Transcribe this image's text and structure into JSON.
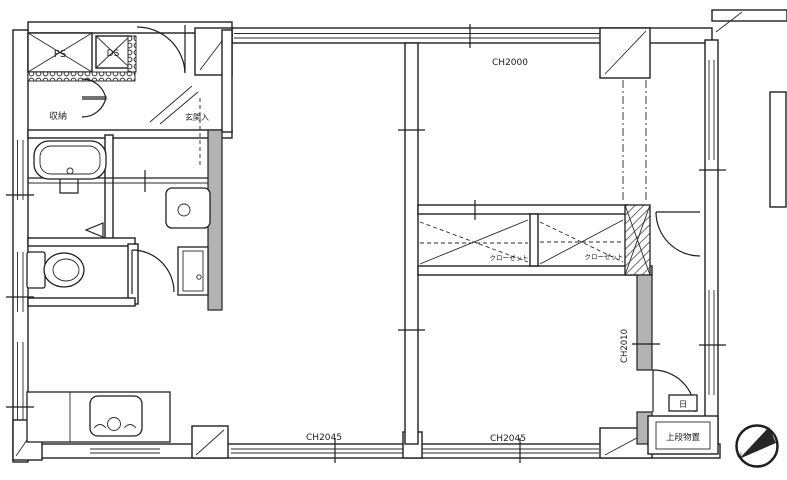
{
  "meta": {
    "type": "apartment-floor-plan",
    "language": "ja"
  },
  "labels": {
    "pipe_space": "PS",
    "duct_space": "DS",
    "storage": "収納",
    "entrance": "玄関入",
    "ceiling_height_main": "CH2000",
    "closet_1": "クローゼット",
    "closet_2": "クローゼット",
    "ceiling_height_side": "CH2010",
    "ceiling_height_bottom_left": "CH2045",
    "ceiling_height_bottom_right": "CH2045",
    "upper_shelf_storage": "上段物置",
    "meter_box": "日",
    "compass_north": "N"
  },
  "colors": {
    "ink": "#1f1f1f",
    "wall_gray": "#b3b3b3",
    "background": "#ffffff",
    "compass_wedge": "#262626"
  }
}
